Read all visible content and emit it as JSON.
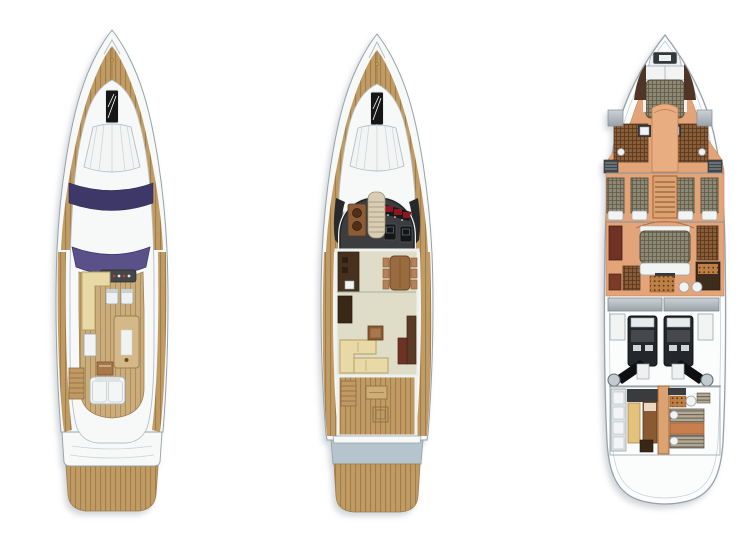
{
  "canvas": {
    "width": 742,
    "height": 542
  },
  "figure": {
    "type": "yacht-deck-plans-illustration",
    "plans": [
      {
        "label": "flybridge deck plan",
        "position": "left",
        "features": [
          "bow-pulpit",
          "foredeck-sunpad",
          "deck-hatch",
          "navy-windscreen",
          "flybridge-windscreen",
          "helm-console",
          "helm-seats",
          "wet-bar",
          "side-table",
          "flybridge-table",
          "sun-lounger",
          "stairs",
          "side-decks",
          "transom",
          "teak-swim-platform"
        ]
      },
      {
        "label": "main deck plan",
        "position": "center",
        "features": [
          "foredeck-sunpad",
          "deck-hatch",
          "wheelhouse",
          "instrument-panel",
          "helm-seats",
          "companionway-stairs",
          "galley",
          "dining-table-with-chairs",
          "salon-sofa",
          "coffee-table",
          "aft-cockpit",
          "cockpit-table",
          "swim-platform"
        ]
      },
      {
        "label": "lower deck plan",
        "position": "right",
        "features": [
          "anchor-locker",
          "vip-cabin-bed",
          "ensuite-heads",
          "hull-hatches",
          "twin-guest-cabins",
          "central-staircase",
          "master-cabin-bed",
          "master-bathroom",
          "fuel-tanks",
          "engine-room",
          "twin-engines",
          "propeller-shafts",
          "crew-cabin-bunks"
        ]
      }
    ]
  },
  "palette": {
    "page-bg": "#ffffff",
    "hull-white": "#f7f9f8",
    "hull-line": "#97a1a8",
    "inner-line": "#c9d1d6",
    "superstructure-line": "#b6bfc5",
    "teak": "#c19b64",
    "teak-line": "#a07d4b",
    "teak-light": "#cbad7d",
    "teak-light-line": "#ae8e5b",
    "navy": "#3e3869",
    "purple": "#5a5188",
    "cream": "#e9d9a6",
    "cream-line": "#b19b62",
    "charcoal": "#3b3d3f",
    "console-gray": "#45484b",
    "red-accent": "#8c1622",
    "wood-brown": "#8a5a33",
    "wood-dark": "#5d3a22",
    "dining-brown": "#9a6b3e",
    "seat-brown": "#b5815a",
    "salon-floor": "#dfddc8",
    "galley-dark": "#46311e",
    "orange-floor": "#e2a478",
    "orange-deep": "#c87f4e",
    "stair-orange": "#dba272",
    "stair-line": "#8a5026",
    "wicker": "#8f8973",
    "wicker-line": "#5e594a",
    "wicker-brown": "#8a5c38",
    "wicker-brown-line": "#55361d",
    "stripe-base": "#b2a995",
    "stripe-line": "#6e6355",
    "dot-base": "#bd7f46",
    "dot-spot": "#5f3414",
    "engine-dark": "#23262a",
    "metal-light": "#ccd2d6",
    "metal-dark": "#9aa3a9",
    "platform-blue": "#b5c4cd",
    "fixture-white": "#f2f4f3",
    "fixture-line": "#9aa4aa",
    "hatch-black": "#161616",
    "vent-dark": "#3f464b",
    "wardrobe-red": "#6e3226"
  }
}
